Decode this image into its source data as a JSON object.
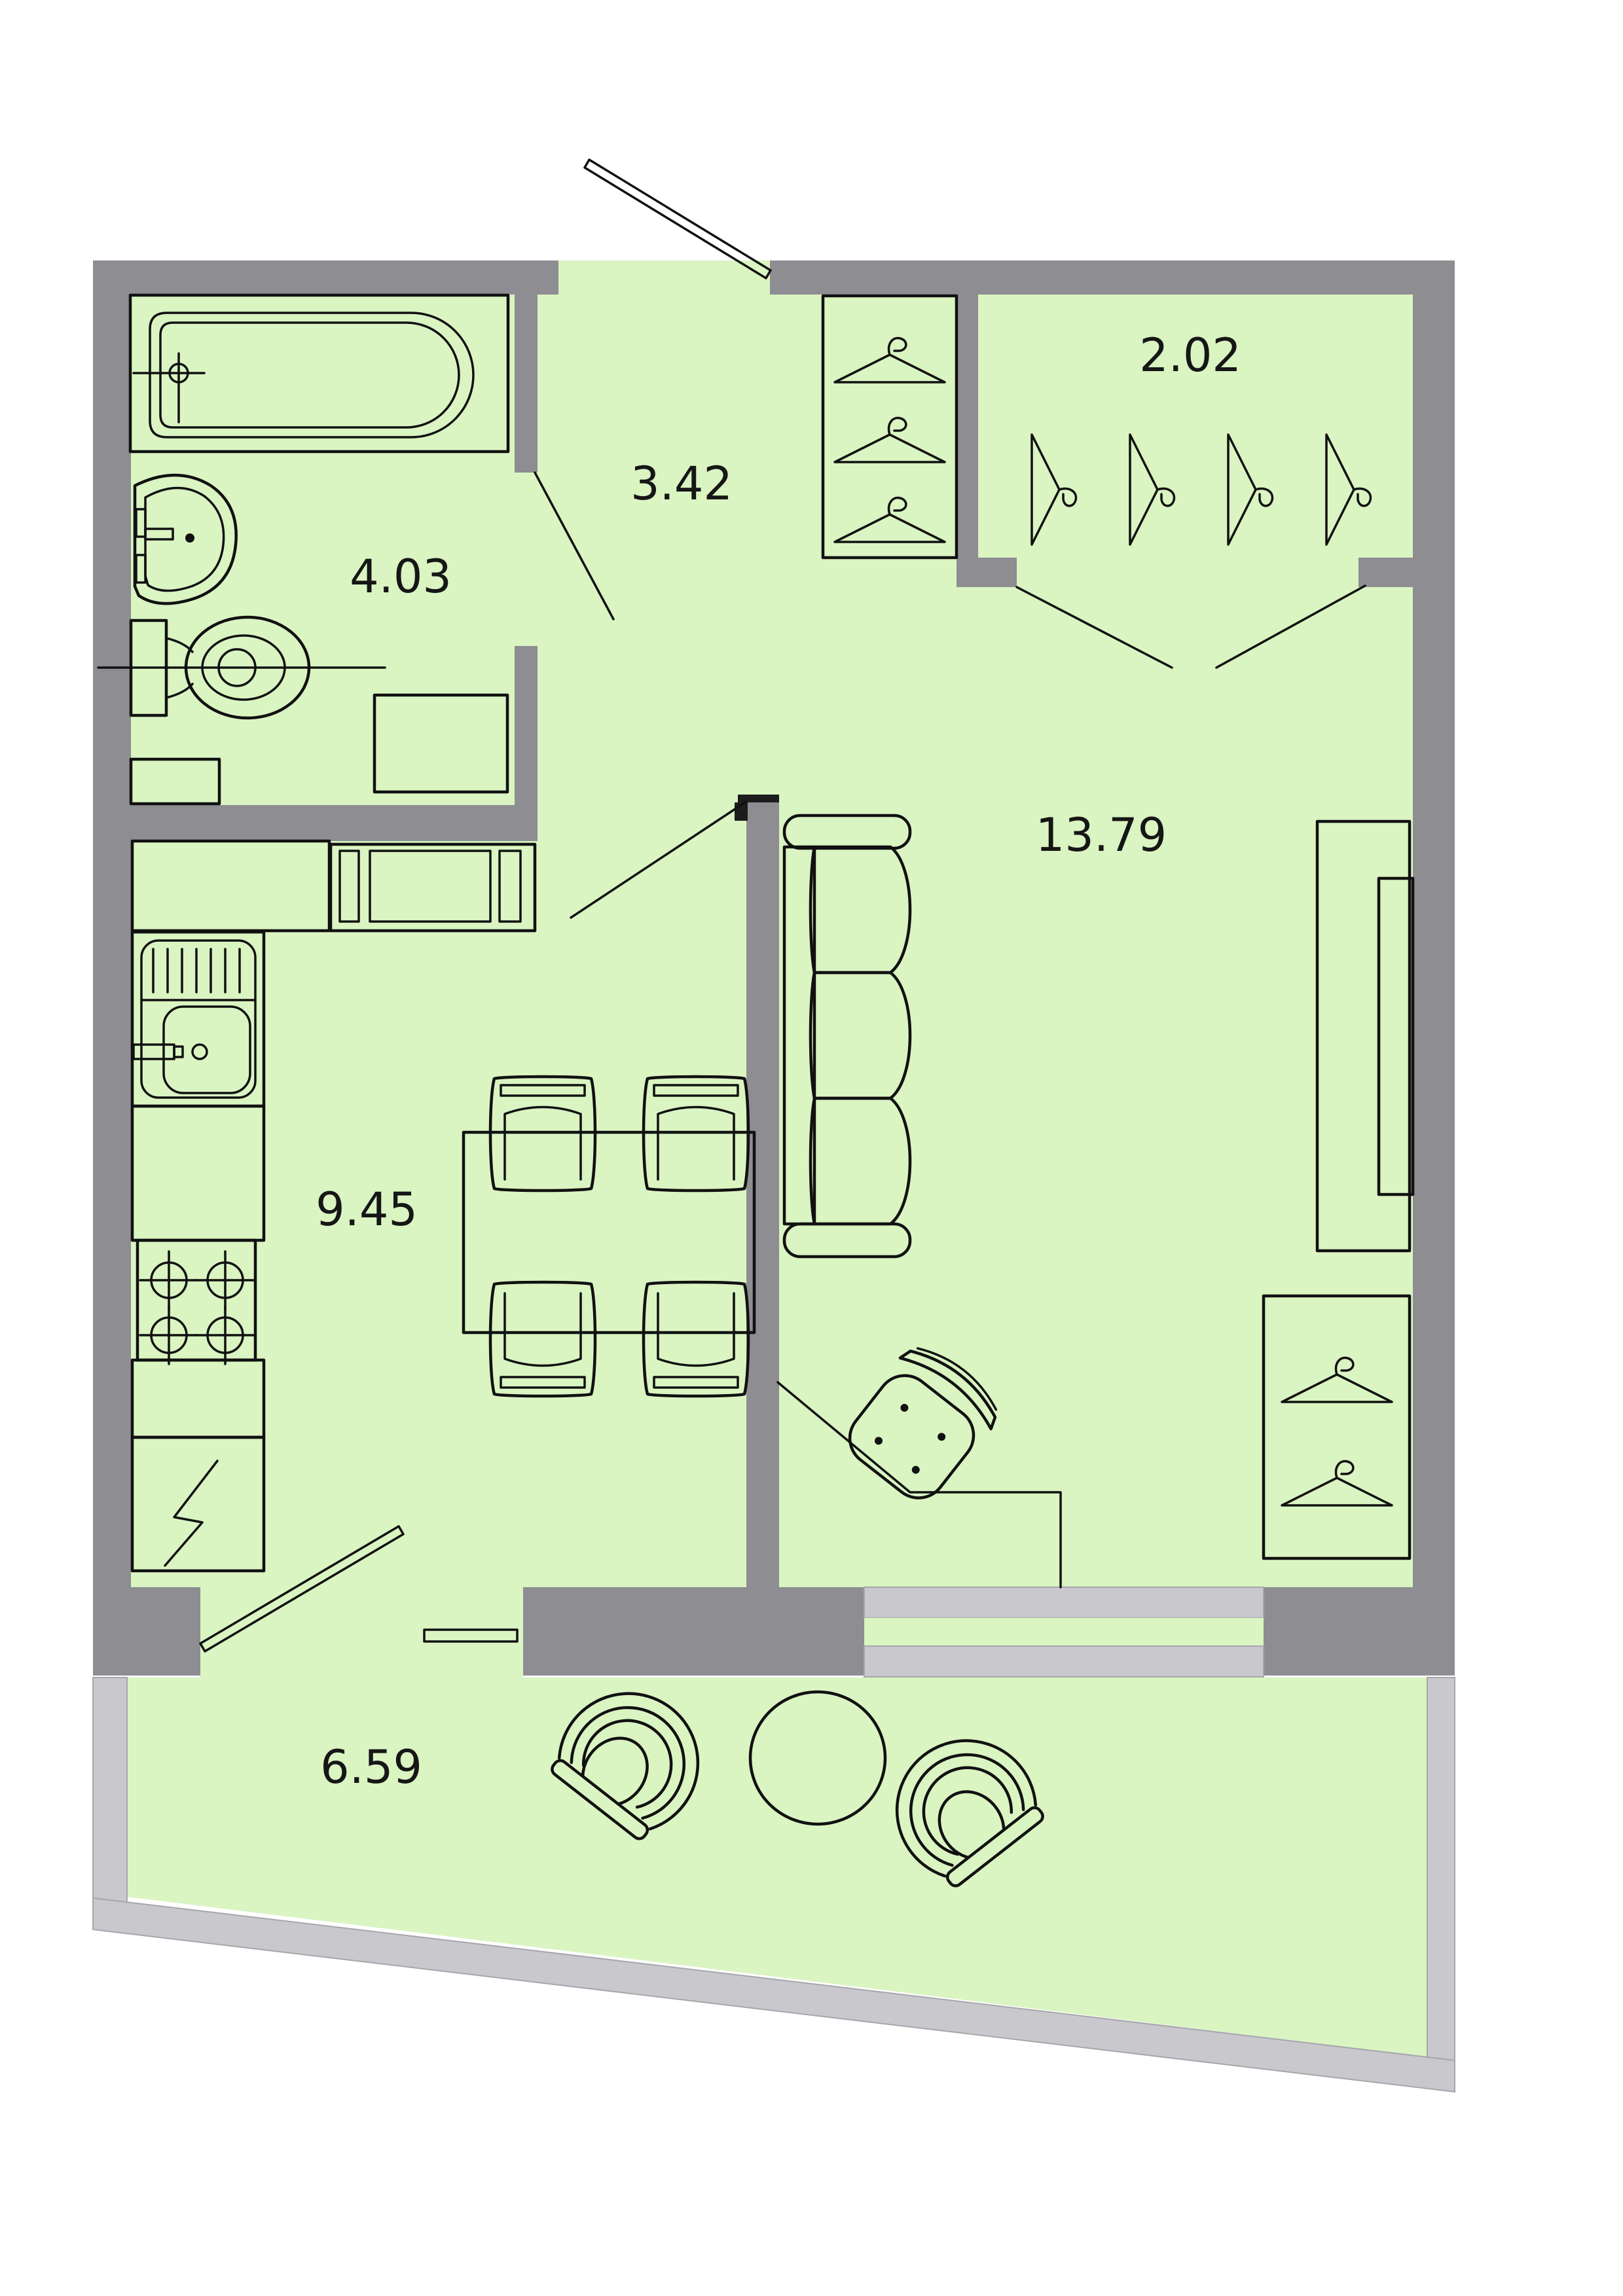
{
  "plan": {
    "type": "apartment-floor-plan",
    "rooms": [
      {
        "id": "bathroom",
        "area_label": "4.03",
        "fixtures": [
          "bathtub",
          "wash-basin",
          "toilet",
          "washing-machine",
          "shelf"
        ]
      },
      {
        "id": "hallway",
        "area_label": "3.42",
        "fixtures": [
          "wardrobe-3-hangers",
          "entrance-door"
        ]
      },
      {
        "id": "closet",
        "area_label": "2.02",
        "fixtures": [
          "hanger-rail-4-hangers",
          "bifold-doors"
        ]
      },
      {
        "id": "living-room",
        "area_label": "13.79",
        "fixtures": [
          "sofa",
          "tv-cabinet",
          "wardrobe-2-hangers",
          "desk",
          "office-chair",
          "window"
        ]
      },
      {
        "id": "kitchen",
        "area_label": "9.45",
        "fixtures": [
          "counter",
          "sink",
          "stove",
          "fridge",
          "dining-table",
          "chairs"
        ]
      },
      {
        "id": "balcony",
        "area_label": "6.59",
        "fixtures": [
          "armchair-left",
          "round-table",
          "armchair-right",
          "balcony-door"
        ]
      }
    ],
    "colors": {
      "wall": "#8d8d92",
      "floor": "#daf4c2",
      "window_glass": "#c8c8cd",
      "line": "#111111",
      "background": "#ffffff"
    },
    "symbols": [
      "hanger-icon",
      "burner-icon",
      "lightning-icon",
      "door-leaf-icon"
    ]
  }
}
